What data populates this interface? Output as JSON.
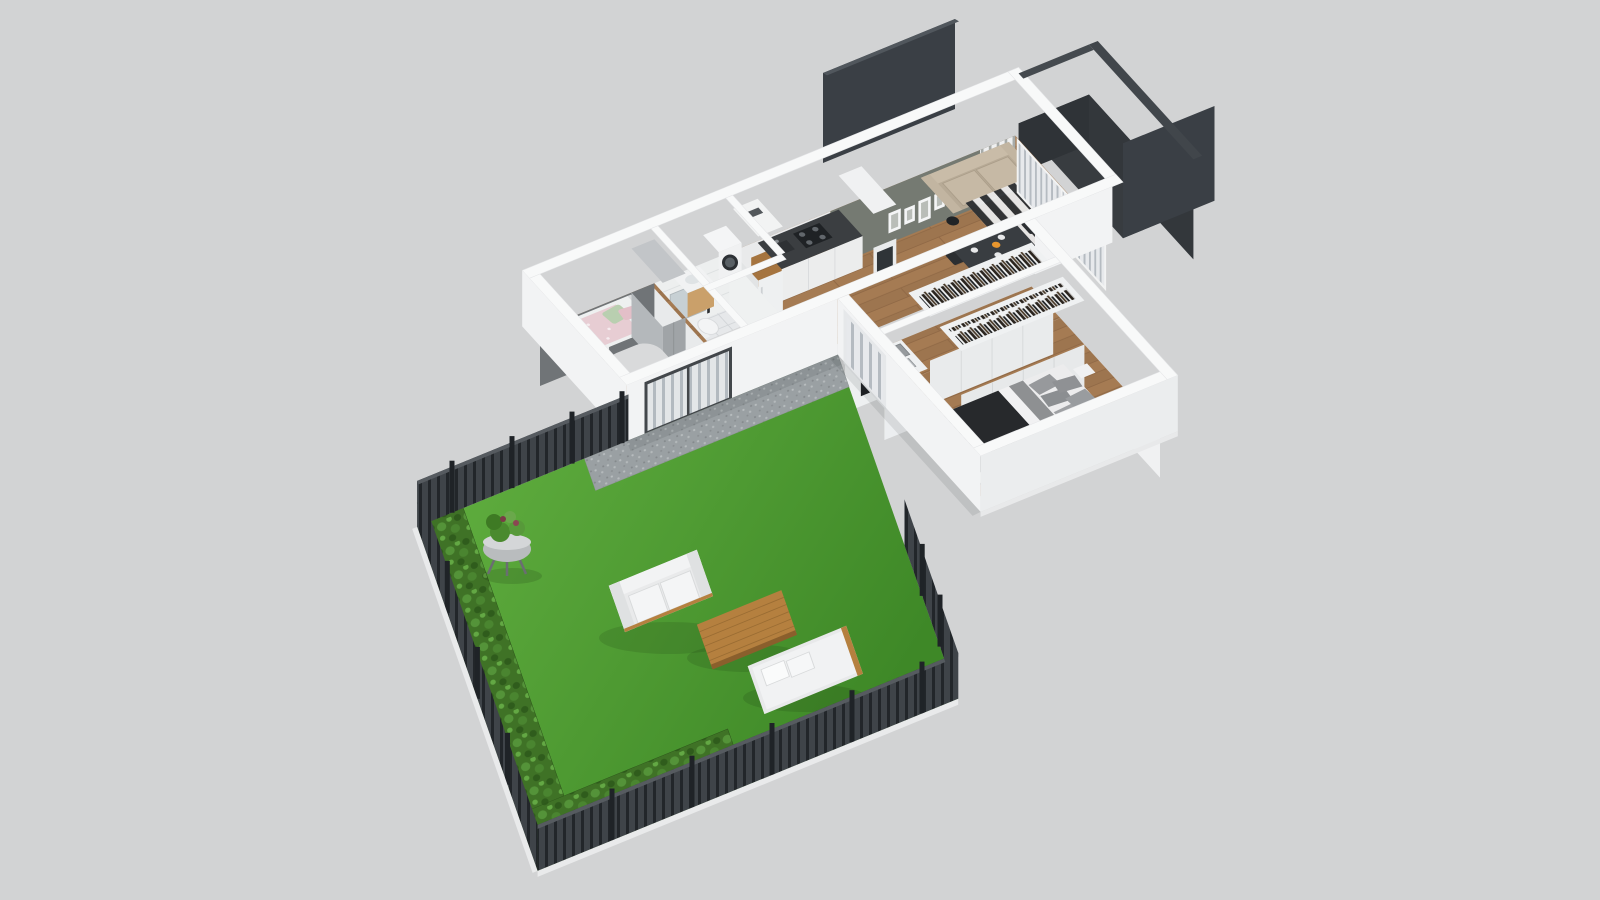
{
  "meta": {
    "title": "3D isometric dollhouse floor plan of a one-bedroom apartment with a private fenced garden",
    "view": "cutaway axonometric render, no text labels visible",
    "background": "#d2d3d4"
  },
  "colors": {
    "bg": "#d2d3d4",
    "wall_top": "#f8f9f9",
    "facade_light": "#f2f3f4",
    "facade_shade": "#ebedee",
    "anthracite_panel": "#3a3f45",
    "balcony_floor": "#383c40",
    "fence_dark": "#22262a",
    "fence_slat": "#3f4449",
    "grass_light": "#5fad3e",
    "grass_dark": "#3e8827",
    "hedge_base": "#3f7226",
    "hedge_dark": "#35641f",
    "gravel_base": "#9aa0a3",
    "wood_floor": "#a57b53",
    "wood_floor_line": "#8f6845",
    "accent_wall_living": "#757a72",
    "accent_wall_kids": "#707477",
    "rug_dark": "#2d3033",
    "rug_light": "#e9e9e9",
    "sofa_beige": "#b7aa96",
    "bed_blanket": "#27292c",
    "glass_pane": "#9aa3ab",
    "wood_furniture": "#b5803f",
    "orange_accent": "#e8962e",
    "kid_bed_pink": "#e7cdd3",
    "kid_pillow_green": "#b9cfb0"
  },
  "apartment": {
    "rooms": [
      {
        "name": "kids-room",
        "contents": [
          "single bed with pink floral duvet and green pillow",
          "grey wardrobe",
          "white dresser with TV and orange book",
          "fluffy grey rug with teddy bear",
          "grey accent wall with two framed pictures",
          "glazed doors to the garden path"
        ]
      },
      {
        "name": "bathroom",
        "contents": [
          "white subway tiled walls",
          "washing machine",
          "wood vanity with sink",
          "mirror with two black sconces",
          "toilet"
        ]
      },
      {
        "name": "hallway",
        "contents": [
          "wooden floor",
          "white interior doors"
        ]
      },
      {
        "name": "kitchen",
        "contents": [
          "dark worktop with hob and sink",
          "wood panel backsplash",
          "black extractor hood",
          "white fridge",
          "oven cabinet"
        ]
      },
      {
        "name": "living-room",
        "contents": [
          "beige leather sofa",
          "black floor lamp",
          "black and white striped rug",
          "dark dining table with black chairs and tableware",
          "olive accent wall with four picture frames",
          "sliding glass wall with sheer vertical blinds"
        ]
      },
      {
        "name": "dressing-corridor",
        "contents": [
          "open white wardrobes full of hanging clothes",
          "shelving with grey storage boxes",
          "wall mounted TV",
          "white door"
        ]
      },
      {
        "name": "bedroom",
        "contents": [
          "double bed with dark charcoal blanket and grey pillows",
          "second open wardrobe row with clothes",
          "black ball lamp",
          "glazed door with vertical blinds to the garden"
        ]
      },
      {
        "name": "balcony",
        "contents": [
          "anthracite parapet walls",
          "dark grey floor",
          "small green plant"
        ]
      }
    ]
  },
  "garden": {
    "features": [
      "green lawn",
      "clipped hedge along two sides",
      "anthracite vertical-slat fence with posts",
      "grey gravel path along the house",
      "round concrete planter bowl with plants",
      "white outdoor sofa with cushions",
      "wooden slatted coffee table",
      "white daybed lounger"
    ]
  }
}
